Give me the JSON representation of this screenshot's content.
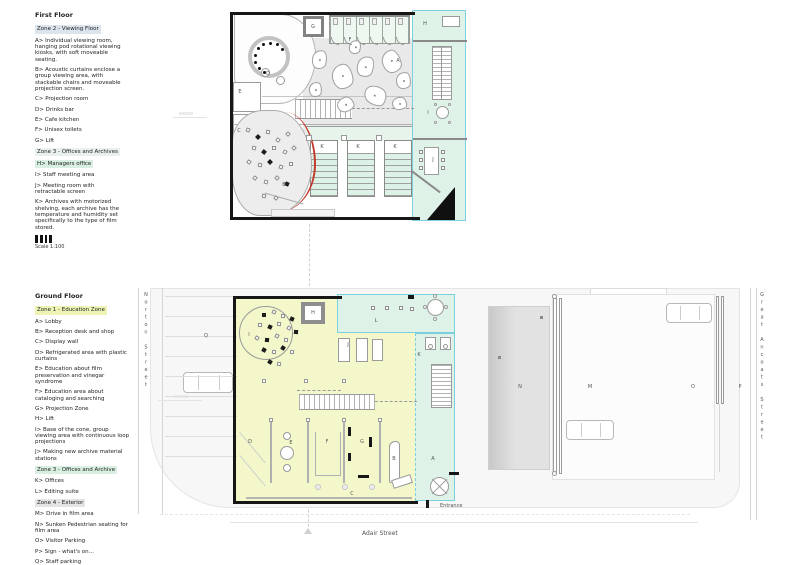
{
  "first_floor": {
    "title": "First Floor",
    "rows": [
      {
        "z": true,
        "c": "#dce4ed",
        "t": "Zone 2 - Viewing Floor"
      },
      {
        "t": "A>  Individual viewing room, hanging pod rotational viewing kiosks, with soft moveable seating."
      },
      {
        "t": "B>  Acoustic curtains enclose a group viewing area, with stackable chairs and moveable projection screen."
      },
      {
        "t": "C>  Projection room"
      },
      {
        "t": "D>  Drinks bar"
      },
      {
        "t": "E>  Cafe kitchen"
      },
      {
        "t": "F>  Unisex toilets"
      },
      {
        "t": "G>  Lift"
      },
      {
        "z": true,
        "c": "#e9f1ec",
        "t": "Zone 3 - Offices and Archives"
      },
      {
        "z": true,
        "c": "#d9efe1",
        "t": "H>  Managers office"
      },
      {
        "t": "I>  Staff meeting area"
      },
      {
        "t": "J>  Meeting room with retractable screen"
      },
      {
        "t": "K>  Archives with motorized shelving, each archive has the temperature and humidity set specifically to the type of film stored."
      }
    ],
    "scale": "Scale 1:100",
    "letters": [
      {
        "t": "A",
        "x": 398,
        "y": 61
      },
      {
        "t": "B",
        "x": 284,
        "y": 185
      },
      {
        "t": "C",
        "x": 239,
        "y": 131
      },
      {
        "t": "D",
        "x": 268,
        "y": 74
      },
      {
        "t": "E",
        "x": 240,
        "y": 92
      },
      {
        "t": "F",
        "x": 350,
        "y": 40
      },
      {
        "t": "G",
        "x": 313,
        "y": 27
      },
      {
        "t": "H",
        "x": 425,
        "y": 24
      },
      {
        "t": "I",
        "x": 428,
        "y": 113
      },
      {
        "t": "J",
        "x": 433,
        "y": 160
      },
      {
        "t": "K",
        "x": 322,
        "y": 147
      },
      {
        "t": "K",
        "x": 358,
        "y": 147
      },
      {
        "t": "K",
        "x": 395,
        "y": 147
      }
    ]
  },
  "ground_floor": {
    "title": "Ground Floor",
    "rows": [
      {
        "z": true,
        "c": "#eff4b5",
        "t": "Zone 1 - Education Zone"
      },
      {
        "t": "A>  Lobby"
      },
      {
        "t": "B>  Reception desk and shop"
      },
      {
        "t": "C>  Display wall"
      },
      {
        "t": "D>  Refrigerated area with plastic curtains"
      },
      {
        "t": "E>  Education about film preservation and vinegar syndrome"
      },
      {
        "t": "F>  Education area about cataloging and searching"
      },
      {
        "t": "G>  Projection Zone"
      },
      {
        "t": "H>  Lift"
      },
      {
        "t": "I>  Base of the cone, group viewing area with continuous loop projections"
      },
      {
        "t": "J>  Making new archive material stations"
      },
      {
        "z": true,
        "c": "#d9efe1",
        "t": "Zone 3 - Offices and Archive"
      },
      {
        "t": "K>  Offices"
      },
      {
        "t": "L> Editing suite"
      },
      {
        "z": true,
        "c": "#e4e4e4",
        "t": "Zone 4 - Exterior"
      },
      {
        "t": "M>  Drive in film area"
      },
      {
        "t": "N>  Sunken Pedestrian seating for film area"
      },
      {
        "t": "O>  Visitor Parking"
      },
      {
        "t": "P>  Sign - what's on..."
      },
      {
        "t": "Q>  Staff parking"
      }
    ],
    "scale": "Scale 1:100",
    "entrance_label": "Entrance",
    "letters": [
      {
        "t": "A",
        "x": 433,
        "y": 459
      },
      {
        "t": "B",
        "x": 394,
        "y": 459
      },
      {
        "t": "C",
        "x": 352,
        "y": 494
      },
      {
        "t": "D",
        "x": 250,
        "y": 442
      },
      {
        "t": "E",
        "x": 291,
        "y": 443
      },
      {
        "t": "F",
        "x": 327,
        "y": 442
      },
      {
        "t": "G",
        "x": 362,
        "y": 442
      },
      {
        "t": "H",
        "x": 313,
        "y": 313
      },
      {
        "t": "I",
        "x": 249,
        "y": 335
      },
      {
        "t": "J",
        "x": 348,
        "y": 345
      },
      {
        "t": "K",
        "x": 419,
        "y": 355
      },
      {
        "t": "L",
        "x": 376,
        "y": 321
      },
      {
        "t": "M",
        "x": 590,
        "y": 387
      },
      {
        "t": "N",
        "x": 520,
        "y": 387
      },
      {
        "t": "O",
        "x": 693,
        "y": 387
      },
      {
        "t": "P",
        "x": 740,
        "y": 387
      },
      {
        "t": "Q",
        "x": 206,
        "y": 336
      }
    ]
  },
  "streets": {
    "left": "Norton Street",
    "bottom": "Adair Street",
    "right": "Great Ancoats Street"
  }
}
